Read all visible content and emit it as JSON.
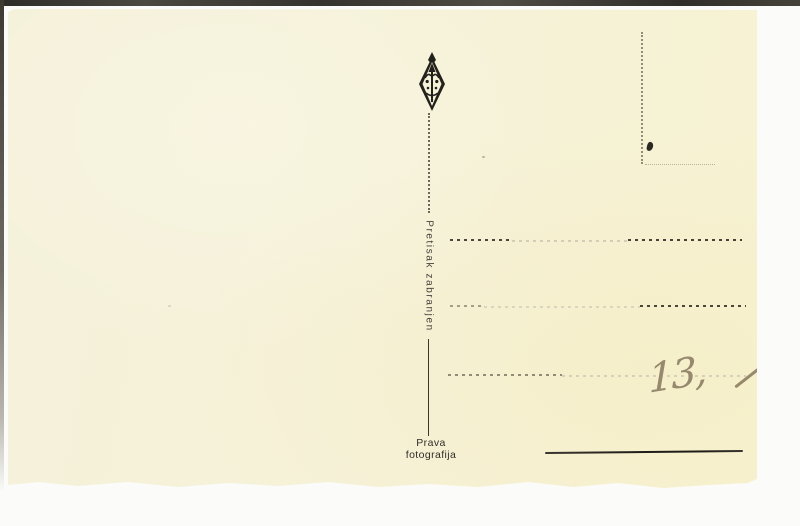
{
  "scan": {
    "colors": {
      "background": "#fbfbf9",
      "card": "#f6f2d8",
      "ink": "#2f2c26",
      "pencil": "#96896e",
      "edge_band": "#35332d"
    }
  },
  "postcard": {
    "icons": {
      "publisher_mark": "diamond-monogram"
    },
    "reprint_notice": "Pretisak zabranjen",
    "photo_note": {
      "line1": "Prava",
      "line2": "fotografija"
    },
    "handwriting": {
      "price": "13,"
    }
  }
}
